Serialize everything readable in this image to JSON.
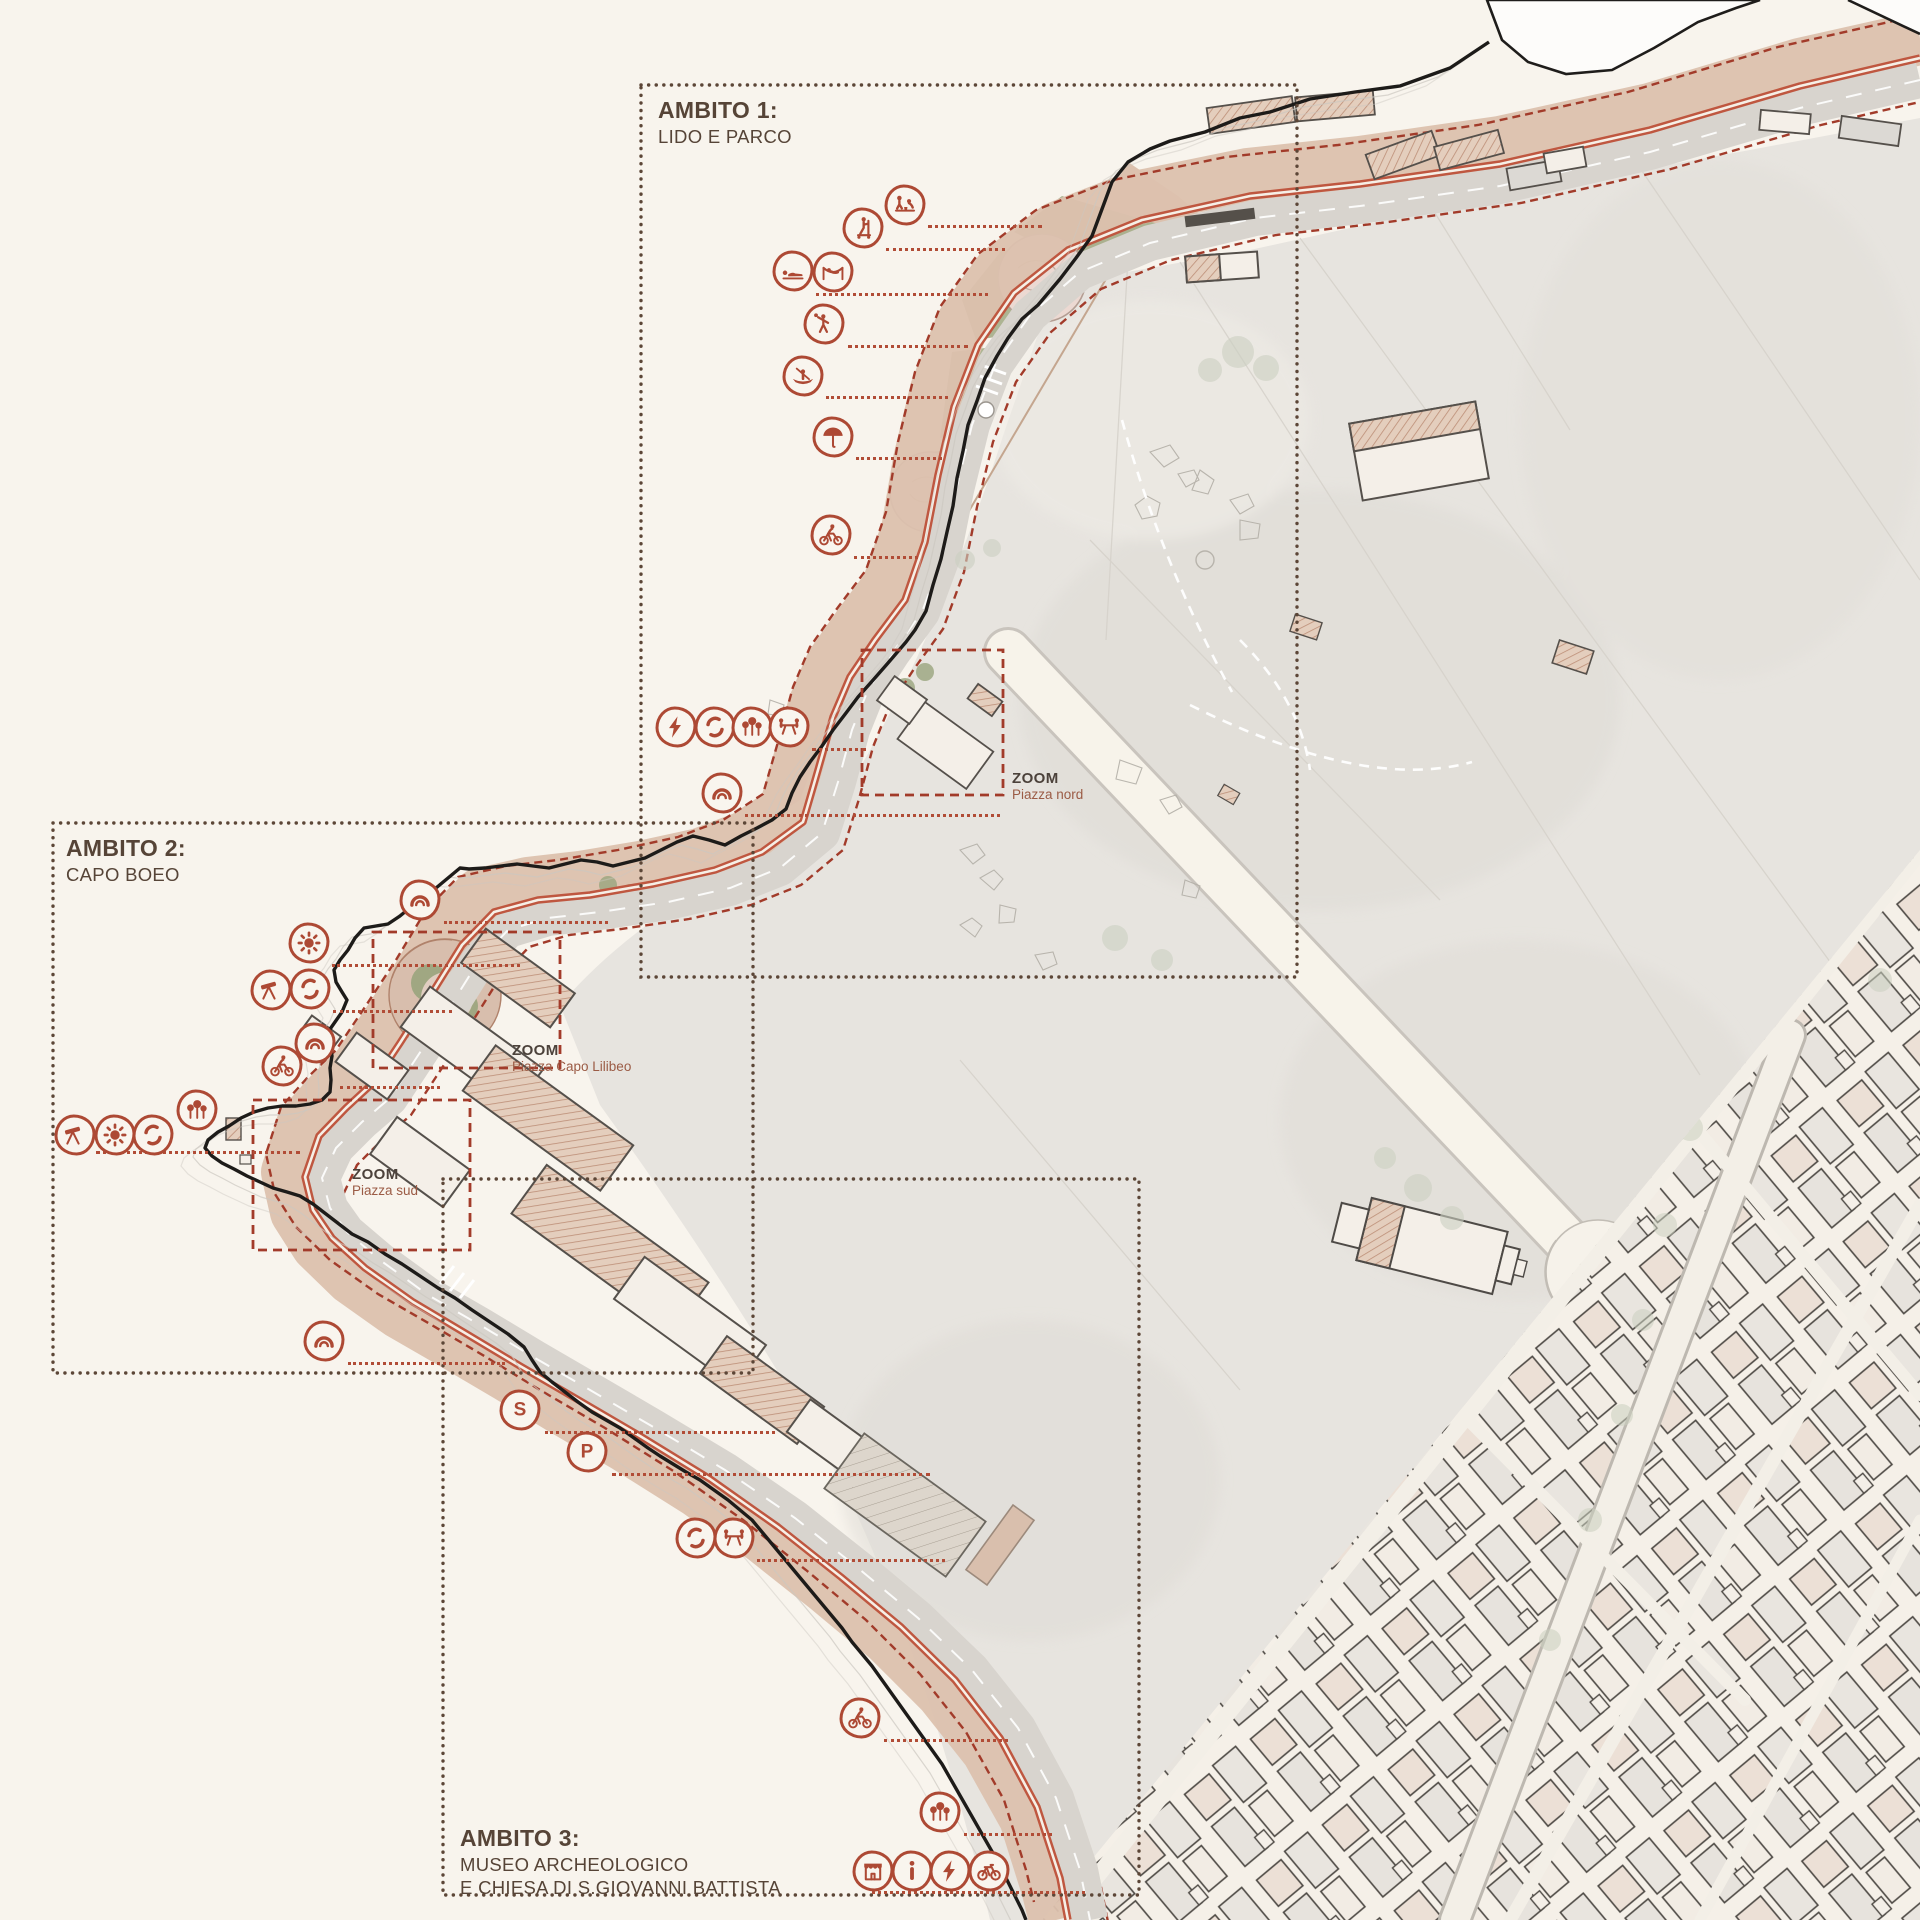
{
  "map": {
    "zones": [
      {
        "id": "ambito-1",
        "title": "AMBITO 1:",
        "subtitle": "LIDO E PARCO"
      },
      {
        "id": "ambito-2",
        "title": "AMBITO 2:",
        "subtitle": "CAPO BOEO"
      },
      {
        "id": "ambito-3",
        "title": "AMBITO 3:",
        "subtitle": "MUSEO ARCHEOLOGICO",
        "subtitle2": "E CHIESA DI S.GIOVANNI BATTISTA"
      }
    ],
    "zoom_callouts": [
      {
        "label": "ZOOM",
        "name": "Piazza nord"
      },
      {
        "label": "ZOOM",
        "name": "Piazza Capo Lilibeo"
      },
      {
        "label": "ZOOM",
        "name": "Piazza sud"
      }
    ],
    "icons": [
      {
        "glyph": "sandcastle-play",
        "x": 905,
        "y": 205
      },
      {
        "glyph": "kick-scooter",
        "x": 863,
        "y": 228
      },
      {
        "glyph": "sunbathing",
        "x": 793,
        "y": 271
      },
      {
        "glyph": "hammock",
        "x": 833,
        "y": 272
      },
      {
        "glyph": "beach-games",
        "x": 824,
        "y": 324
      },
      {
        "glyph": "canoe",
        "x": 803,
        "y": 376
      },
      {
        "glyph": "beach-umbrella",
        "x": 833,
        "y": 437
      },
      {
        "glyph": "cycling",
        "x": 831,
        "y": 535
      },
      {
        "glyph": "electric-charge",
        "x": 676,
        "y": 727
      },
      {
        "glyph": "loop-path",
        "x": 715,
        "y": 727
      },
      {
        "glyph": "park-trees",
        "x": 752,
        "y": 727
      },
      {
        "glyph": "picnic-area",
        "x": 789,
        "y": 727
      },
      {
        "glyph": "panoramic-arch",
        "x": 722,
        "y": 793
      },
      {
        "glyph": "panoramic-arch",
        "x": 420,
        "y": 900
      },
      {
        "glyph": "sun-solarium",
        "x": 309,
        "y": 943
      },
      {
        "glyph": "telescope-viewpoint",
        "x": 271,
        "y": 990
      },
      {
        "glyph": "loop-path",
        "x": 310,
        "y": 989
      },
      {
        "glyph": "panoramic-arch",
        "x": 315,
        "y": 1043
      },
      {
        "glyph": "cycling",
        "x": 282,
        "y": 1066
      },
      {
        "glyph": "telescope-viewpoint",
        "x": 75,
        "y": 1135
      },
      {
        "glyph": "sun-solarium",
        "x": 115,
        "y": 1135
      },
      {
        "glyph": "loop-path",
        "x": 153,
        "y": 1135
      },
      {
        "glyph": "park-trees",
        "x": 197,
        "y": 1110
      },
      {
        "glyph": "panoramic-arch",
        "x": 324,
        "y": 1341
      },
      {
        "glyph": "shuttle-stop",
        "x": 520,
        "y": 1410,
        "label": "S"
      },
      {
        "glyph": "parking",
        "x": 587,
        "y": 1452,
        "label": "P"
      },
      {
        "glyph": "loop-path",
        "x": 696,
        "y": 1538
      },
      {
        "glyph": "picnic-area",
        "x": 734,
        "y": 1538
      },
      {
        "glyph": "cycling",
        "x": 860,
        "y": 1718
      },
      {
        "glyph": "park-trees",
        "x": 940,
        "y": 1812
      },
      {
        "glyph": "kiosk",
        "x": 873,
        "y": 1871
      },
      {
        "glyph": "info-point",
        "x": 912,
        "y": 1871
      },
      {
        "glyph": "electric-charge",
        "x": 950,
        "y": 1871
      },
      {
        "glyph": "bike-rental",
        "x": 989,
        "y": 1871
      }
    ],
    "leaders": [
      {
        "x1": 928,
        "y": 225,
        "x2": 1042
      },
      {
        "x1": 886,
        "y": 248,
        "x2": 1005
      },
      {
        "x1": 816,
        "y": 293,
        "x2": 988
      },
      {
        "x1": 848,
        "y": 345,
        "x2": 968
      },
      {
        "x1": 826,
        "y": 396,
        "x2": 948
      },
      {
        "x1": 856,
        "y": 457,
        "x2": 942
      },
      {
        "x1": 854,
        "y": 556,
        "x2": 918
      },
      {
        "x1": 812,
        "y": 748,
        "x2": 866
      },
      {
        "x1": 745,
        "y": 814,
        "x2": 1000
      },
      {
        "x1": 444,
        "y": 921,
        "x2": 608
      },
      {
        "x1": 332,
        "y": 964,
        "x2": 520
      },
      {
        "x1": 333,
        "y": 1010,
        "x2": 452
      },
      {
        "x1": 340,
        "y": 1086,
        "x2": 440
      },
      {
        "x1": 96,
        "y": 1151,
        "x2": 300
      },
      {
        "x1": 348,
        "y": 1362,
        "x2": 505
      },
      {
        "x1": 545,
        "y": 1431,
        "x2": 775
      },
      {
        "x1": 612,
        "y": 1473,
        "x2": 930
      },
      {
        "x1": 757,
        "y": 1559,
        "x2": 945
      },
      {
        "x1": 884,
        "y": 1739,
        "x2": 1008
      },
      {
        "x1": 964,
        "y": 1833,
        "x2": 1052
      },
      {
        "x1": 872,
        "y": 1891,
        "x2": 1085
      }
    ],
    "colors": {
      "background": "#f8f4ed",
      "accent_red": "#ad4934",
      "dashed_red": "#a23b2a",
      "zone_border_brown": "#5c4637",
      "text_brown": "#564437",
      "promenade_tan": "#dcc1ae",
      "park_gray": "#e7e4df",
      "green": "#a9b18e",
      "bike_path_red": "#bf5740"
    }
  }
}
